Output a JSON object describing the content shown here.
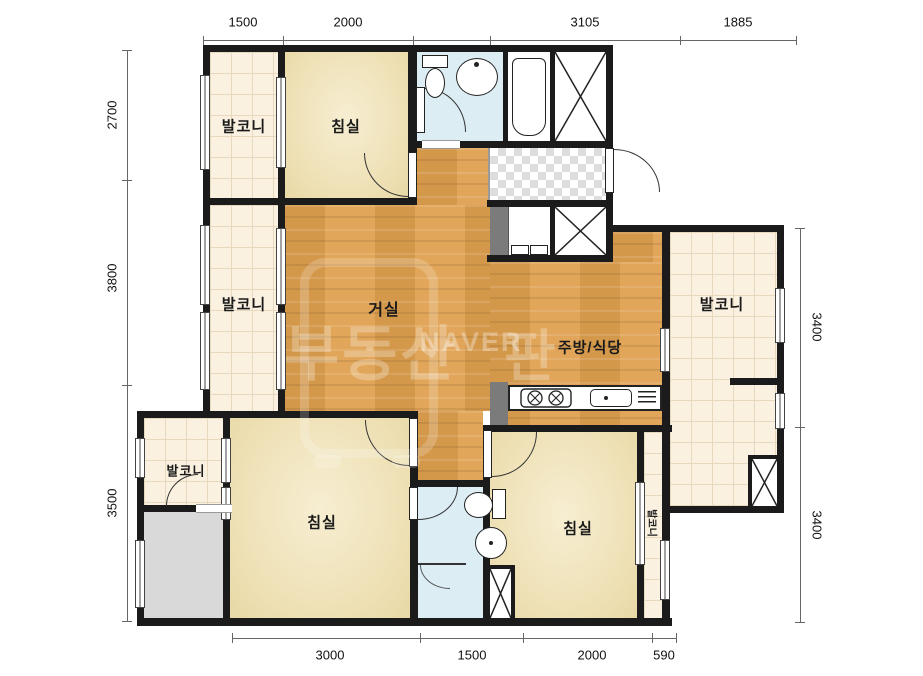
{
  "dimensions": {
    "top": [
      "1500",
      "2000",
      "3105",
      "1885"
    ],
    "left": [
      "2700",
      "3800",
      "3500"
    ],
    "right": [
      "3400",
      "3400"
    ],
    "bottom": [
      "3000",
      "1500",
      "2000",
      "590"
    ]
  },
  "rooms": {
    "balcony_top_left": "발코니",
    "bedroom_top": "침실",
    "balcony_mid_left": "발코니",
    "living": "거실",
    "kitchen_dining": "주방/식당",
    "balcony_right": "발코니",
    "balcony_bottom_left": "발코니",
    "bedroom_bottom_left": "침실",
    "bedroom_bottom_right": "침실",
    "balcony_strip": "발코니"
  },
  "watermark": {
    "brand_left": "부동산",
    "brand_center": "NAVER",
    "brand_right": "판"
  }
}
